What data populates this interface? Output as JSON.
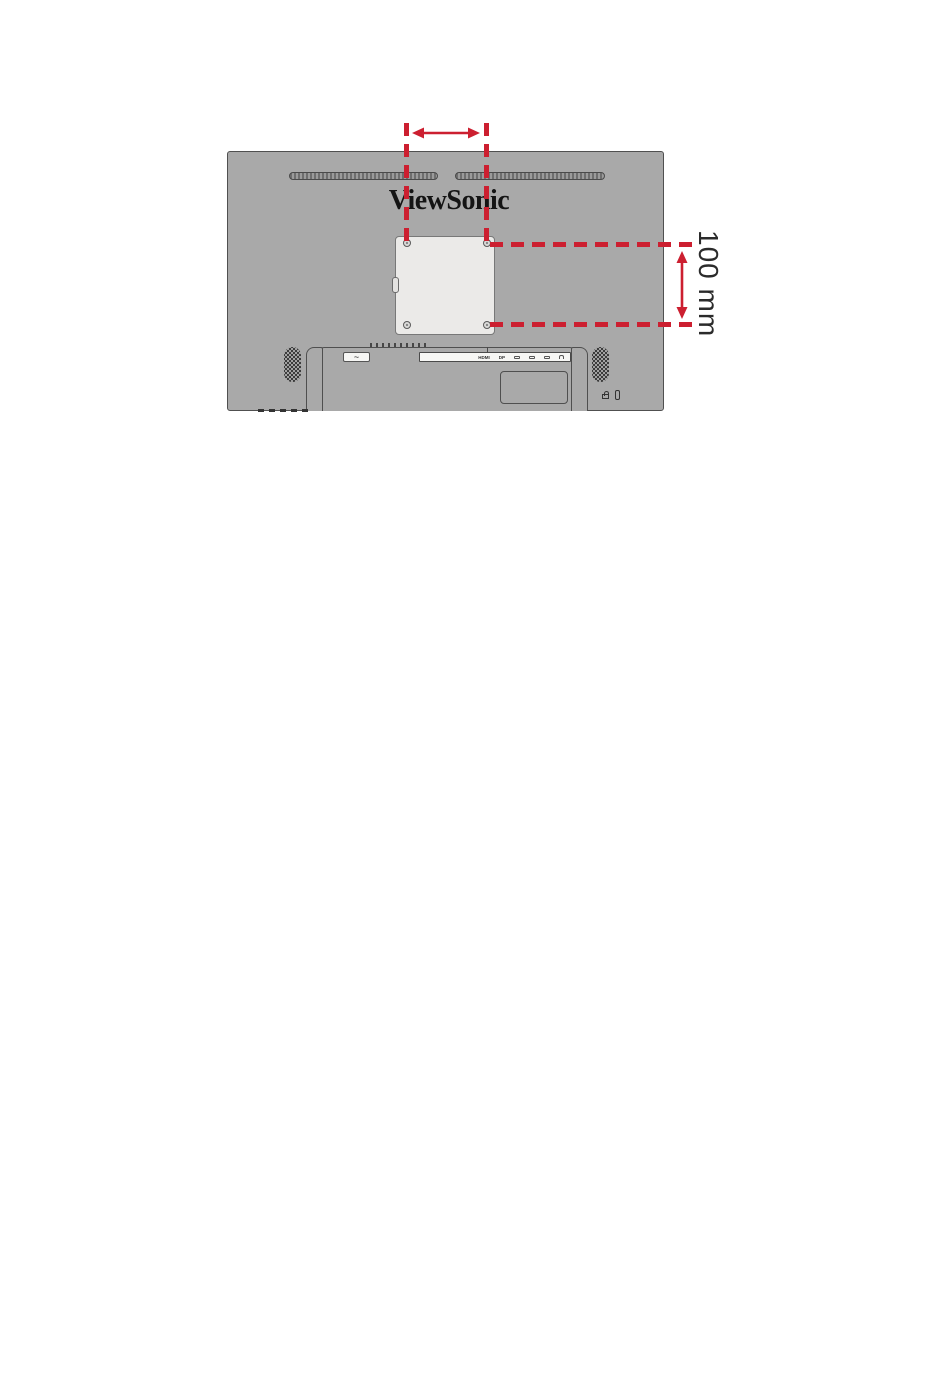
{
  "colors": {
    "accent_red": "#cc1f30",
    "monitor_gray": "#a9a9a9",
    "plate_gray": "#ebeae8",
    "line_dark": "#4a4a4a",
    "logo_black": "#141414",
    "label_dark": "#2b2b2b",
    "panel_white": "#f6f6f4"
  },
  "diagram": {
    "brand_logo": "ViewSonic",
    "vertical_dimension_label": "100 mm",
    "power_symbol": "~",
    "ports": {
      "labels": [
        "HDMI",
        "DP"
      ],
      "icon_names": [
        "usb-c-port-icon",
        "usb-port-icon",
        "usb-port-icon",
        "audio-out-icon"
      ]
    }
  }
}
